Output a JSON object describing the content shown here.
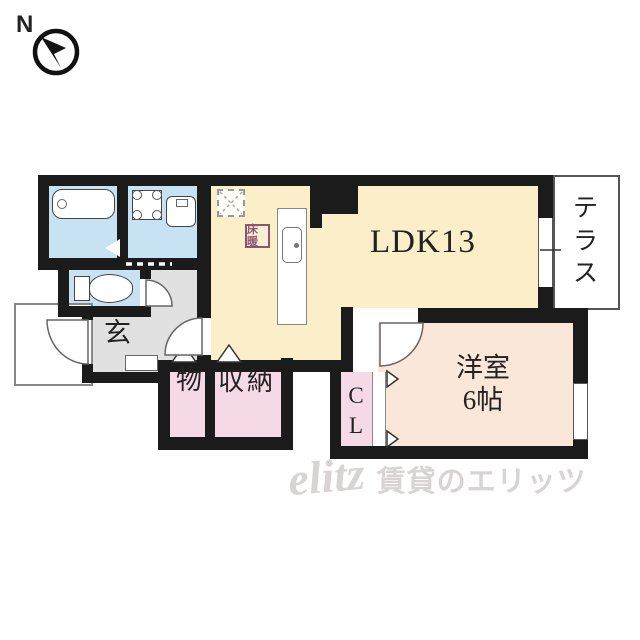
{
  "compass": {
    "north_label": "N"
  },
  "rooms": {
    "ldk": {
      "label": "LDK13"
    },
    "terrace": {
      "label": "テラス"
    },
    "western": {
      "label": "洋室",
      "size": "6帖"
    },
    "genkan": {
      "label": "玄"
    },
    "storage_small": {
      "label": "物"
    },
    "storage": {
      "label": "収納"
    },
    "closet": {
      "label": "CL"
    }
  },
  "stamps": {
    "floor_heating": "床暖"
  },
  "watermark": {
    "logo": "elitz",
    "text": "賃貸のエリッツ"
  },
  "fixtures": {
    "bathtub": "bathtub-icon",
    "washing_machine": "washing-machine-pan-icon",
    "washbasin": "washbasin-icon",
    "toilet": "toilet-icon",
    "kitchen_sink": "kitchen-sink-icon",
    "refrigerator_space": "refrigerator-space-icon",
    "compass": "north-compass-icon"
  },
  "colors": {
    "wall": "#1b1b1b",
    "ldk_cream": "#faefc8",
    "wet_blue": "#c6e2f3",
    "hall_gray": "#e1e1e1",
    "closet_pink": "#f6d9e6",
    "western_pink": "#fbe7d9",
    "stamp": "#8d5570",
    "watermark_gray": "#d8d4d4"
  }
}
